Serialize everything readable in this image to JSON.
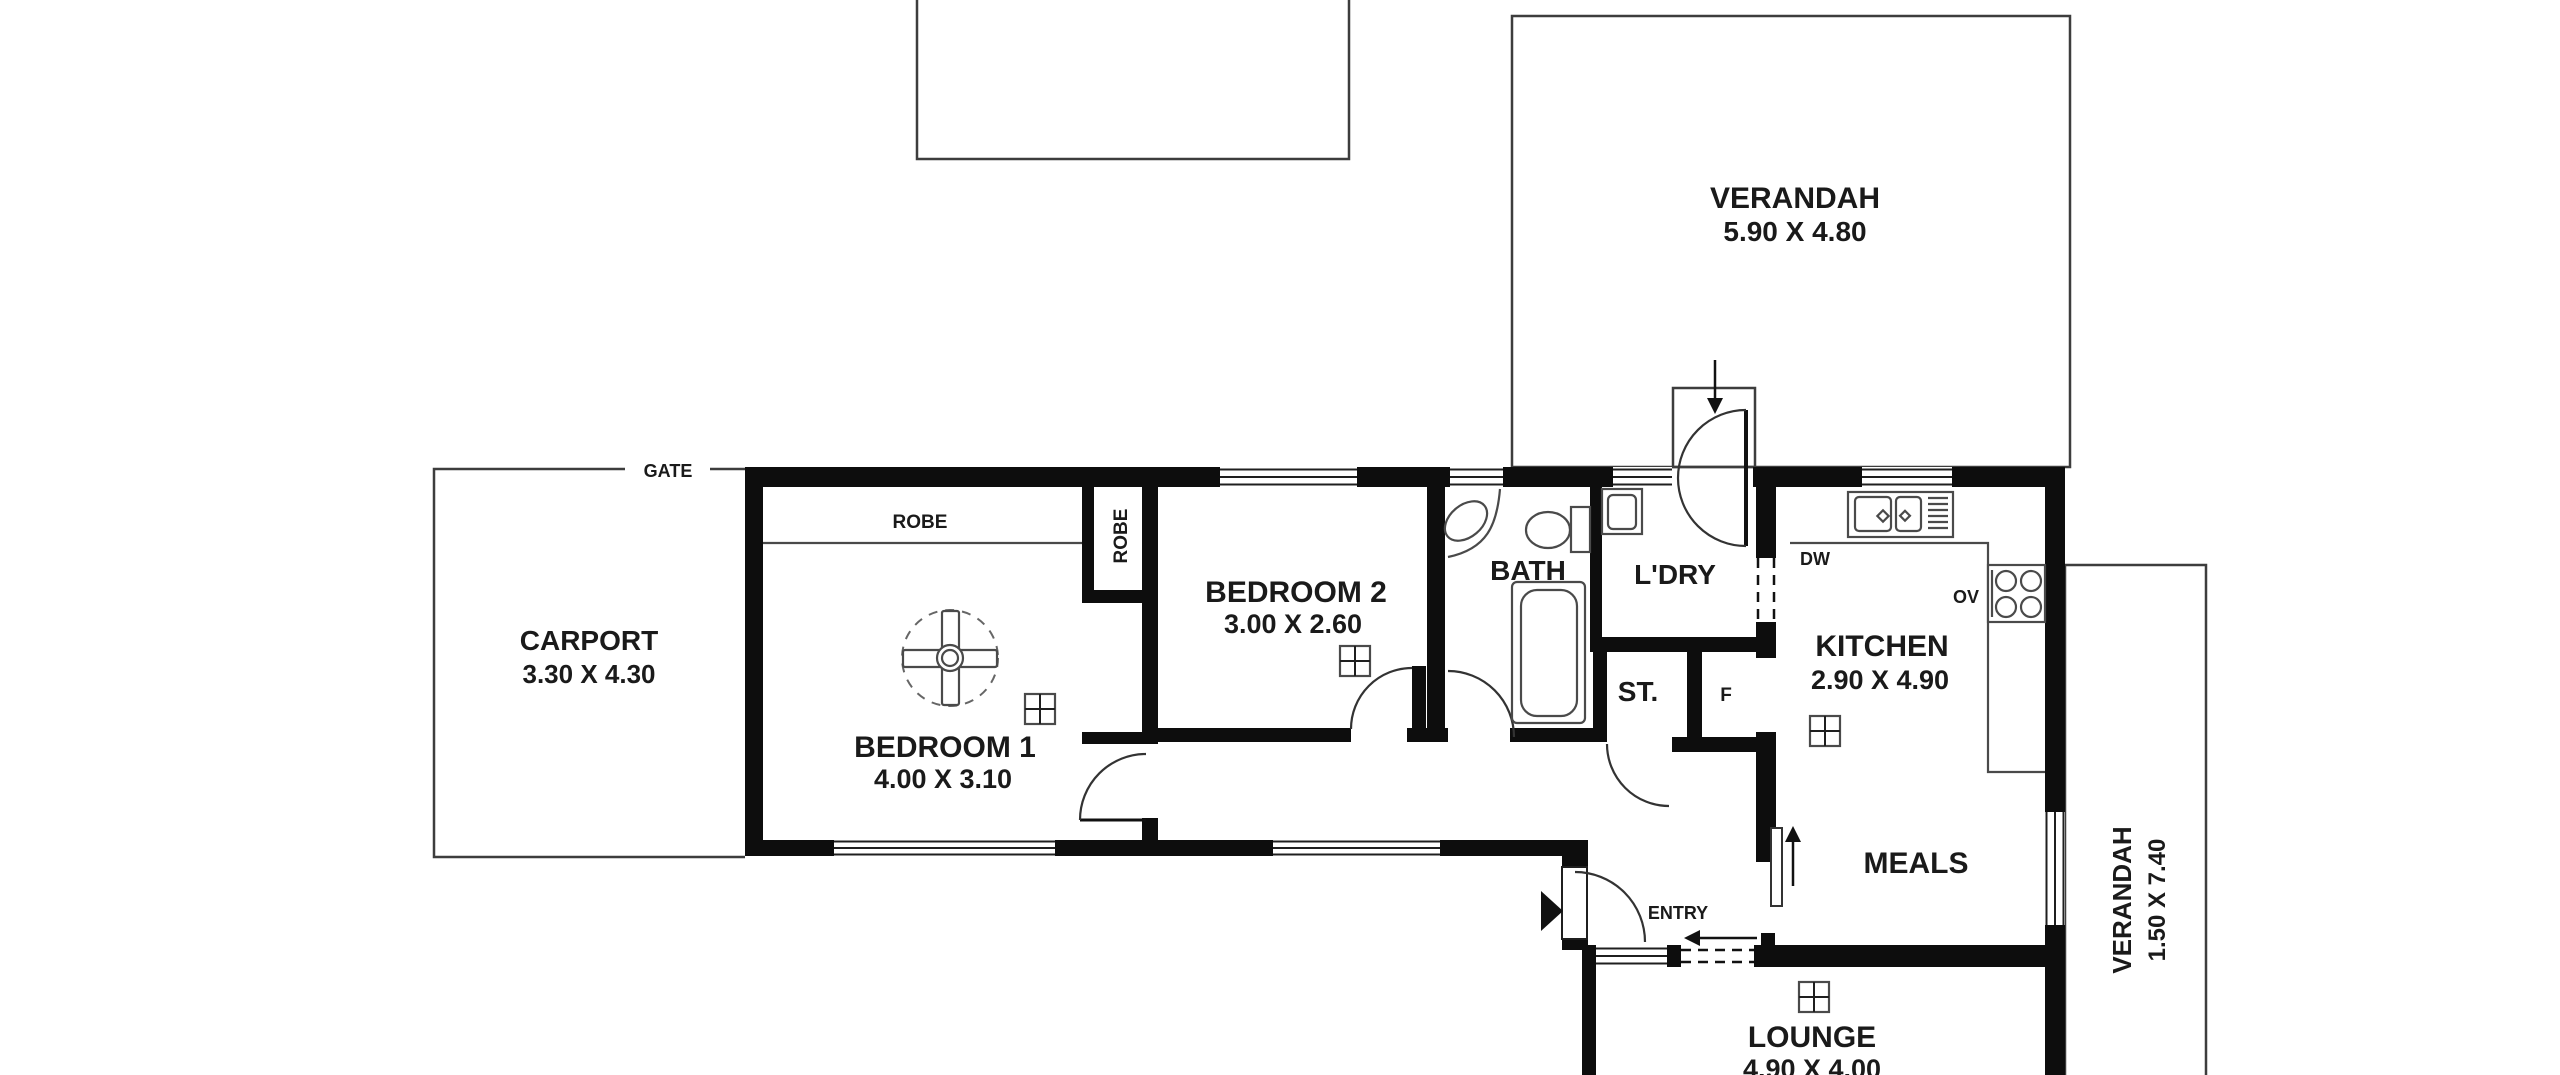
{
  "plan": {
    "colors": {
      "wall": "#0d0d0d",
      "outline": "#3d3d3d",
      "fixture": "#4a4a4a",
      "text": "#1a1a1a",
      "background": "#ffffff"
    },
    "rooms": {
      "verandah_top": {
        "name": "VERANDAH",
        "dims": "5.90 X 4.80"
      },
      "carport": {
        "name": "CARPORT",
        "dims": "3.30 X 4.30"
      },
      "bedroom1": {
        "name": "BEDROOM 1",
        "dims": "4.00 X 3.10"
      },
      "bedroom2": {
        "name": "BEDROOM 2",
        "dims": "3.00 X 2.60"
      },
      "bath": {
        "name": "BATH"
      },
      "laundry": {
        "name": "L'DRY"
      },
      "store": {
        "name": "ST."
      },
      "kitchen": {
        "name": "KITCHEN",
        "dims": "2.90 X 4.90"
      },
      "meals": {
        "name": "MEALS"
      },
      "lounge": {
        "name": "LOUNGE",
        "dims": "4.90 X 4.00"
      },
      "verandah_right": {
        "name": "VERANDAH",
        "dims": "1.50 X 7.40"
      }
    },
    "annotations": {
      "gate": "GATE",
      "robe_bed1": "ROBE",
      "robe_bed2": "ROBE",
      "entry": "ENTRY",
      "dishwasher": "DW",
      "oven": "OV",
      "fridge": "F"
    }
  }
}
